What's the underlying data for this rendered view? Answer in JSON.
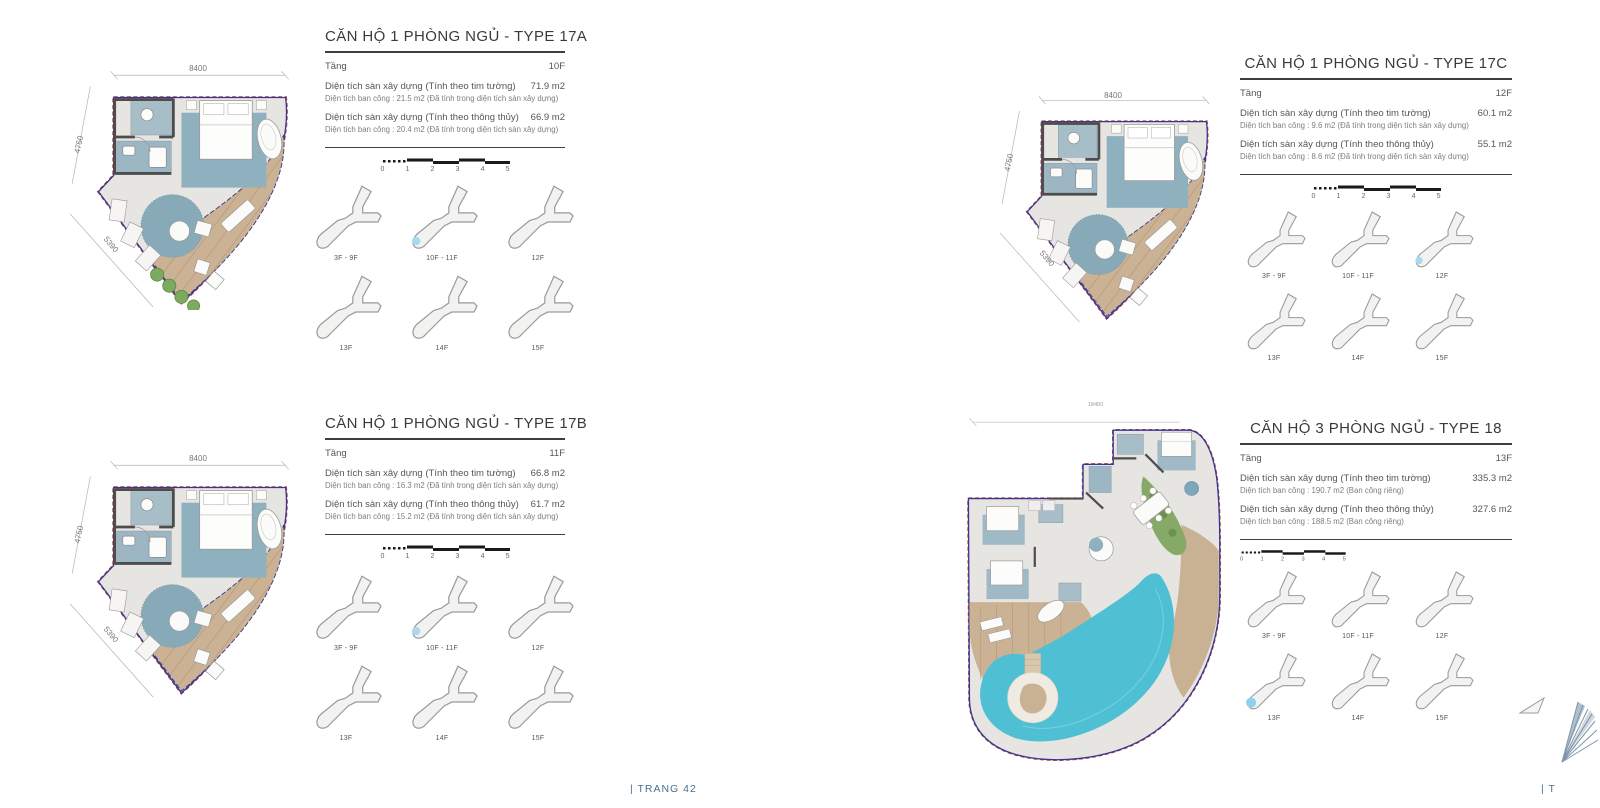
{
  "page": {
    "footer_center": "| TRANG 42",
    "footer_right": "| T"
  },
  "scale_bar": {
    "ticks": [
      "0",
      "1",
      "2",
      "3",
      "4",
      "5"
    ]
  },
  "floor_grid_labels": [
    "3F - 9F",
    "10F - 11F",
    "12F",
    "13F",
    "14F",
    "15F"
  ],
  "colors": {
    "outline_blue": "#35398e",
    "outline_red": "#c23b3b",
    "deck_wood": "#ccb294",
    "pool": "#4fc0d4",
    "highlight_blue": "#a9d9ef",
    "footer_text": "#4a708c"
  },
  "panels": [
    {
      "id": "type-17a",
      "title": "CĂN HỘ 1 PHÒNG NGỦ - TYPE 17A",
      "floor_label": "Tầng",
      "floor_value": "10F",
      "area1_label": "Diện tích sàn xây dựng (Tính theo tim tường)",
      "area1_value": "71.9 m2",
      "note1": "Diện tích ban công : 21.5 m2 (Đã tính trong diện tích sàn xây dựng)",
      "area2_label": "Diện tích sàn xây dựng (Tính theo thông thủy)",
      "area2_value": "66.9 m2",
      "note2": "Diện tích ban công : 20.4 m2 (Đã tính trong diện tích sàn xây dựng)",
      "dimensions": {
        "top": "8400",
        "left": "4750",
        "diagonal": "5390"
      },
      "highlighted_floor": "10F - 11F"
    },
    {
      "id": "type-17b",
      "title": "CĂN HỘ 1 PHÒNG NGỦ - TYPE 17B",
      "floor_label": "Tầng",
      "floor_value": "11F",
      "area1_label": "Diện tích sàn xây dựng (Tính theo tim tường)",
      "area1_value": "66.8 m2",
      "note1": "Diện tích ban công : 16.3 m2 (Đã tính trong diện tích sàn xây dựng)",
      "area2_label": "Diện tích sàn xây dựng (Tính theo thông thủy)",
      "area2_value": "61.7 m2",
      "note2": "Diện tích ban công : 15.2 m2 (Đã tính trong diện tích sàn xây dựng)",
      "dimensions": {
        "top": "8400",
        "left": "4750",
        "diagonal": "5390"
      },
      "highlighted_floor": "10F - 11F"
    },
    {
      "id": "type-17c",
      "title": "CĂN HỘ 1 PHÒNG NGỦ - TYPE 17C",
      "floor_label": "Tầng",
      "floor_value": "12F",
      "area1_label": "Diện tích sàn xây dựng (Tính theo tim tường)",
      "area1_value": "60.1 m2",
      "note1": "Diện tích ban công : 9.6 m2 (Đã tính trong diện tích sàn xây dựng)",
      "area2_label": "Diện tích sàn xây dựng (Tính theo thông thủy)",
      "area2_value": "55.1 m2",
      "note2": "Diện tích ban công : 8.6 m2 (Đã tính trong diện tích sàn xây dựng)",
      "dimensions": {
        "top": "8400",
        "left": "4750",
        "diagonal": "5390"
      },
      "highlighted_floor": "12F"
    },
    {
      "id": "type-18",
      "title": "CĂN HỘ 3 PHÒNG NGỦ - TYPE 18",
      "floor_label": "Tầng",
      "floor_value": "13F",
      "area1_label": "Diện tích sàn xây dựng (Tính theo tim tường)",
      "area1_value": "335.3 m2",
      "note1": "Diện tích ban công : 190.7 m2 (Ban công riêng)",
      "area2_label": "Diện tích sàn xây dựng (Tính theo thông thủy)",
      "area2_value": "327.6 m2",
      "note2": "Diện tích ban công : 188.5 m2 (Ban công riêng)",
      "dimensions": {
        "top": "18450"
      },
      "highlighted_floor": "13F"
    }
  ]
}
